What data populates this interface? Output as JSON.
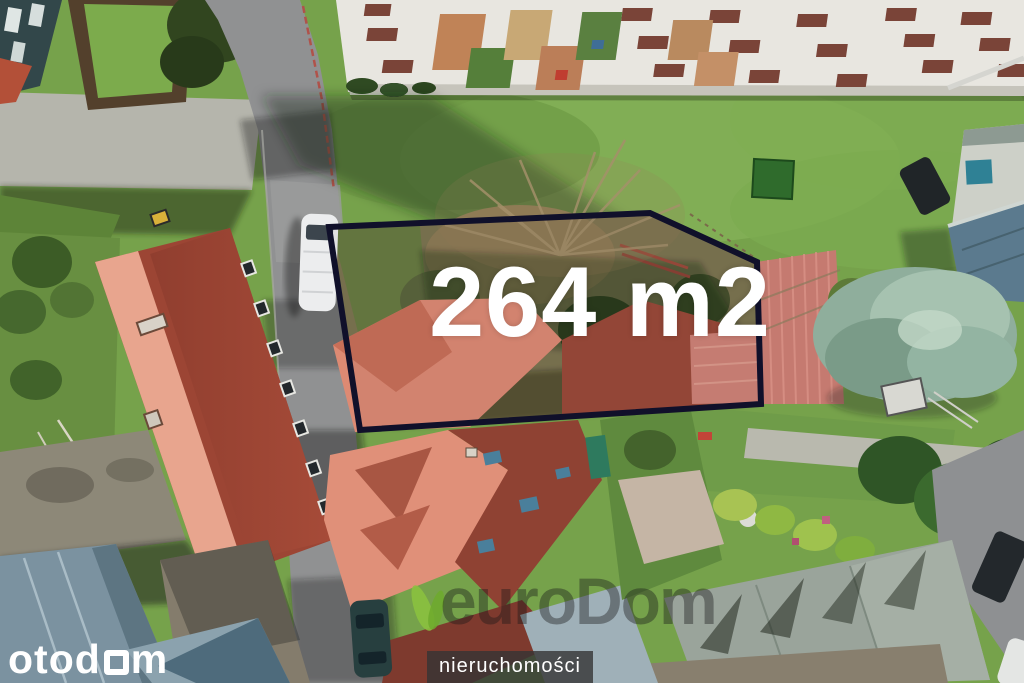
{
  "image": {
    "kind": "aerial-drone-photo",
    "subject": "building plot for sale between houses, apartment blocks and gardens",
    "width_px": 1024,
    "height_px": 683
  },
  "plot": {
    "area_label": "264 m2",
    "area_value": 264,
    "area_unit": "m2",
    "outline_color": "#10102a",
    "outline_points": "329,227 650,213 757,262 761,404 360,430"
  },
  "overlay": {
    "area_label": "264 m2",
    "brand": "otodom",
    "brand_prefix": "otod",
    "brand_suffix": "m",
    "brand_square_glyph": "square-o-icon",
    "agency_logo_text": "euroDom",
    "agency_subtitle": "nieruchomości",
    "agency_leaf_icon": "leaf-icon"
  },
  "colors": {
    "plot_outline": "#10102a",
    "label_text": "#ffffff",
    "brand_text": "#ffffff",
    "agency_leaf_green": "#8bc13f",
    "agency_bar_bg": "rgba(52,52,52,0.8)",
    "grass": "#76a24b",
    "roof_salmon": "#dd8a73",
    "roof_dark_red": "#97432f",
    "road_gray": "#909192",
    "metal_roof_blue": "#6d8染"
  }
}
